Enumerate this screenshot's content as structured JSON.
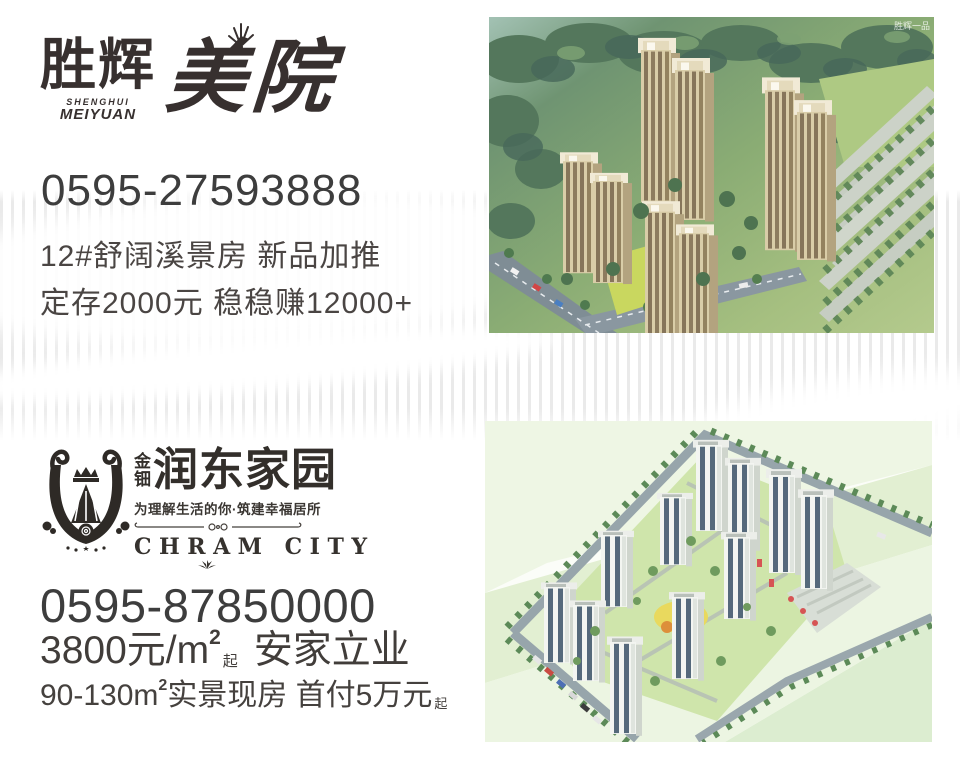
{
  "listing1": {
    "logo_cn_a": "胜辉",
    "logo_cn_b": "美院",
    "logo_latin_1": "SHENGHUI",
    "logo_latin_2": "MEIYUAN",
    "phone": "0595-27593888",
    "line1": "12#舒阔溪景房 新品加推",
    "line2": "定存2000元 稳稳赚12000+",
    "watermark": "胜辉一品"
  },
  "listing2": {
    "logo_small_top": "金",
    "logo_small_bottom": "钿",
    "logo_cn": "润东家园",
    "tagline": "为理解生活的你·筑建幸福居所",
    "latin": "CHRAM CITY",
    "phone": "0595-87850000",
    "price_main": "3800元/m",
    "price_sup": "2",
    "price_sub": "起",
    "price_rest": "安家立业",
    "spec_a": "90-130m",
    "spec_sup": "2",
    "spec_b": "实景现房 首付5万元",
    "spec_sub": "起"
  },
  "colors": {
    "text_dark": "#3c3836",
    "stripe_gray": "#e9e9e9",
    "photo1_green": "#85a873",
    "photo2_pale_green": "#e2efd2"
  }
}
